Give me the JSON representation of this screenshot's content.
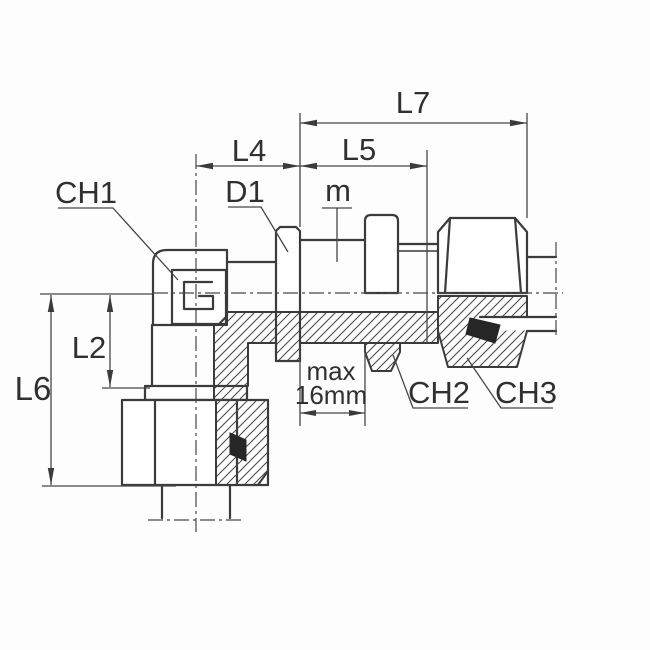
{
  "labels": {
    "l7": "L7",
    "l4": "L4",
    "l5": "L5",
    "d1": "D1",
    "m": "m",
    "ch1": "CH1",
    "l2": "L2",
    "l6": "L6",
    "max_thickness_line1": "max",
    "max_thickness_line2": "16mm",
    "ch2": "CH2",
    "ch3": "CH3"
  },
  "colors": {
    "background": "#fdfdfd",
    "part_line": "#3b3b3b",
    "dimension_line": "#474747",
    "seal_ring": "#262626"
  }
}
